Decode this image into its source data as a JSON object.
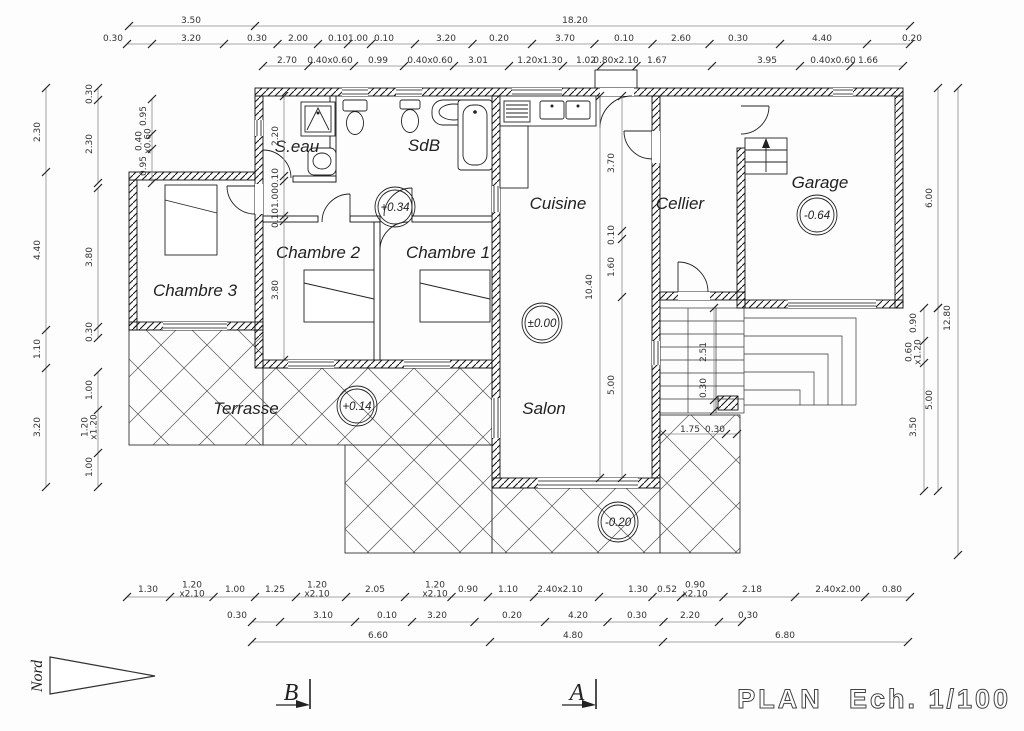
{
  "title": {
    "plan": "PLAN",
    "scale": "Ech. 1/100"
  },
  "north_label": "Nord",
  "sections": {
    "b": "B",
    "a": "A"
  },
  "rooms": {
    "seau": "S.eau",
    "sdb": "SdB",
    "cuisine": "Cuisine",
    "cellier": "Cellier",
    "garage": "Garage",
    "chambre1": "Chambre 1",
    "chambre2": "Chambre 2",
    "chambre3": "Chambre 3",
    "terrasse": "Terrasse",
    "salon": "Salon"
  },
  "levels": {
    "hall": "+0.34",
    "salon": "±0.00",
    "terrasse": "+0.14",
    "lower_terrace": "-0.20",
    "garage": "-0.64"
  },
  "dims": {
    "top1": [
      "3.50",
      "18.20"
    ],
    "top2": [
      "0.30",
      "3.20",
      "0.30",
      "2.00",
      "0.10",
      "1.00",
      "0.10",
      "3.20",
      "0.20",
      "3.70",
      "0.10",
      "2.60",
      "0.30",
      "4.40",
      "0.20"
    ],
    "top3": [
      "2.70",
      "0.40x0.60",
      "0.99",
      "0.40x0.60",
      "3.01",
      "1.20x1.30",
      "1.02",
      "0.80x2.10",
      "1.67",
      "3.95",
      "0.40x0.60",
      "1.66"
    ],
    "bottom1": [
      "1.30",
      "1.20|x2.10",
      "1.00",
      "1.25",
      "1.20|x2.10",
      "2.05",
      "1.20|x2.10",
      "0.90",
      "1.10",
      "2.40x2.10",
      "1.30",
      "0.52",
      "0.90|x2.10",
      "2.18",
      "2.40x2.00",
      "0.80"
    ],
    "bottom2": [
      "0.30",
      "3.10",
      "0.10",
      "3.20",
      "0.20",
      "4.20",
      "0.30",
      "2.20",
      "0.30"
    ],
    "bottom3": [
      "6.60",
      "4.80",
      "6.80"
    ],
    "left_outer": [
      "2.30",
      "4.40",
      "1.10",
      "3.20"
    ],
    "left_inner_a": [
      "0.30",
      "2.30"
    ],
    "left_inner_b": [
      "3.80",
      "0.30"
    ],
    "left_inner_c": [
      "1.00",
      "1.20|x1.20",
      "1.00"
    ],
    "left_win": [
      "0.95",
      "0.40|x0.60",
      "0.95"
    ],
    "hall_v": [
      "2.20",
      "0.10",
      "1.00",
      "0.10",
      "3.80"
    ],
    "center_total": [
      "10.40"
    ],
    "center_v": [
      "3.70",
      "0.10",
      "1.60",
      "5.00"
    ],
    "stair_v": [
      "2.51",
      "0.30"
    ],
    "stair_h": [
      "1.75",
      "0.30"
    ],
    "right_inner": [
      "0.90",
      "0.60|x1.20",
      "3.50"
    ],
    "right_mid_a": [
      "6.00"
    ],
    "right_mid_b": [
      "5.00"
    ],
    "right_outer": [
      "12.80"
    ]
  }
}
